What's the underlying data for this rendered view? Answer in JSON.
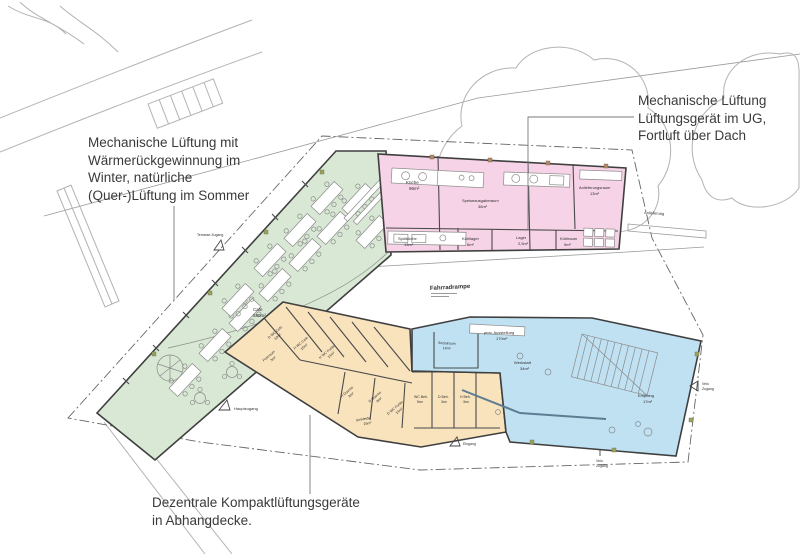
{
  "colors": {
    "green": "#d8e8d4",
    "pink": "#f6d3e6",
    "orange": "#f9e3bd",
    "blue": "#bfe1f2"
  },
  "annotations": {
    "left": {
      "line1": "Mechanische Lüftung mit",
      "line2": "Wärmerückgewinnung im",
      "line3": "Winter, natürliche",
      "line4": "(Quer-)Lüftung im Sommer"
    },
    "top_right": {
      "line1": "Mechanische Lüftung",
      "line2": "Lüftungsgerät im UG,",
      "line3": "Fortluft über Dach"
    },
    "bottom": {
      "line1": "Dezentrale Kompaktlüftungsgeräte",
      "line2": "in Abhangdecke."
    }
  },
  "rooms": {
    "cafe": {
      "name": "Cafe",
      "area": "580m²"
    },
    "kueche": {
      "name": "Küche",
      "area": "96m²"
    },
    "speiseausgabe": {
      "name": "Speiseausgaberaum",
      "area": "36m²"
    },
    "anlieferungsraum": {
      "name": "Anlieferungsraum",
      "area": "13m²"
    },
    "spuelkueche": {
      "name": "Spülküche",
      "area": "13m²"
    },
    "kuehllager": {
      "name": "Kühllager",
      "area": "6m²"
    },
    "lager": {
      "name": "Lager",
      "area": "2,5m²"
    },
    "kuehlraum": {
      "name": "Kühlraum",
      "area": "9m²"
    },
    "wc_d_cafe": {
      "name": "D WC Cafe",
      "area": "10m²"
    },
    "putzraum": {
      "name": "Putzraum",
      "area": "3m²"
    },
    "wc_h_cafe": {
      "name": "H WC Cafe",
      "area": "10m²"
    },
    "wc_h_public": {
      "name": "H WC Public",
      "area": "14m²"
    },
    "dusche_h": {
      "name": "H Dusche",
      "area": "8m²"
    },
    "dusche_d": {
      "name": "D Dusche",
      "area": "8m²"
    },
    "wc_d_public": {
      "name": "D WC Public",
      "area": "14m²"
    },
    "umkleide": {
      "name": "Umkleide",
      "area": "25m²"
    },
    "wc_beh": {
      "name": "WC Beh.",
      "area": "5m²"
    },
    "d_beh": {
      "name": "D Beh.",
      "area": "3m²"
    },
    "h_beh": {
      "name": "H Beh.",
      "area": "3m²"
    },
    "sozialraum": {
      "name": "Sozialraum",
      "area": "14m²"
    },
    "ausstellung": {
      "name": "prov. Ausstellung",
      "area": "170m²"
    },
    "werkstatt": {
      "name": "Werkstatt",
      "area": "34m²"
    },
    "empfang": {
      "name": "Empfang",
      "area": "17m²"
    }
  },
  "site": {
    "fahrradrampe": "Fahrradrampe",
    "anlieferung": "Anlieferung",
    "hauptzugang": "Hauptzugang",
    "terrasse": "Terrasse Zugang",
    "eingang": "Eingang",
    "velo_right_1": "Velo",
    "velo_right_2": "Zugang",
    "velo_bottom_1": "Velo",
    "velo_bottom_2": "Zugang"
  }
}
